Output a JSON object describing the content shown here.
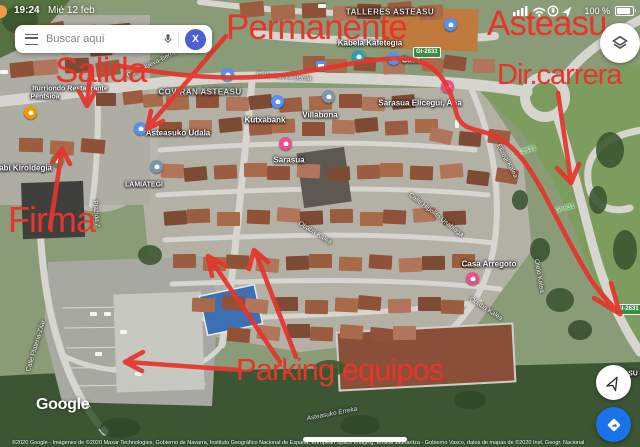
{
  "status_bar": {
    "time": "19:24",
    "date": "Mié 12 feb",
    "battery_percent": "100 %"
  },
  "search_bar": {
    "placeholder": "Buscar aquí",
    "avatar_initial": "X"
  },
  "annotations": {
    "color": "#e5352c",
    "permanente": "Permanente",
    "asteasu": "Asteasu",
    "salida": "Salida",
    "dir_carrera": "Dir.carrera",
    "firma": "Firma",
    "parking_equipos": "Parking equipos"
  },
  "map": {
    "poi_labels": [
      {
        "text": "TALLERES ASTEASU"
      },
      {
        "text": "Kabela Kafetegia"
      },
      {
        "text": "Casa"
      },
      {
        "text": "Iturriondo Restaurante"
      },
      {
        "text": "Pentsioa"
      },
      {
        "text": "COVIRAN ASTEASU"
      },
      {
        "text": "Asteasuko Udala"
      },
      {
        "text": "Kutxabank"
      },
      {
        "text": "Villabona"
      },
      {
        "text": "Sarasua Elicegui, Ana"
      },
      {
        "text": "Sarasua"
      },
      {
        "text": "rabi Kiroldegia"
      },
      {
        "text": "LAMIATEGI"
      },
      {
        "text": "Casa Arregoto"
      },
      {
        "text": "SU"
      }
    ],
    "street_labels": [
      {
        "text": "Calle Nueva-Berria"
      },
      {
        "text": "Calle Nueva-Berria"
      },
      {
        "text": "Obaba Kalea"
      },
      {
        "text": "Calle Hipolito Usabiaga"
      },
      {
        "text": "Obaba Kalea"
      },
      {
        "text": "Otelo Kalea"
      },
      {
        "text": "Calle Plateria-Zilar"
      },
      {
        "text": "Plazida Z"
      },
      {
        "text": "Elizegi Kalea"
      },
      {
        "text": "Asteasuko Erreka"
      }
    ],
    "road_shields": [
      {
        "text": "GI-2631"
      },
      {
        "text": "GI-2631"
      },
      {
        "text": "GI-631"
      },
      {
        "text": "GI-2631"
      }
    ]
  },
  "footer": {
    "logo": "Google",
    "copyright": "©2020 Google - Imágenes de ©2020 Maxar Technologies, Gobierno de Navarra, Instituto Geográfico Nacional de España, European Space Imaging, Euskal Jaurlaritza - Gobierno Vasco, datos de mapas de ©2020 Inst. Geogr. Nacional"
  }
}
